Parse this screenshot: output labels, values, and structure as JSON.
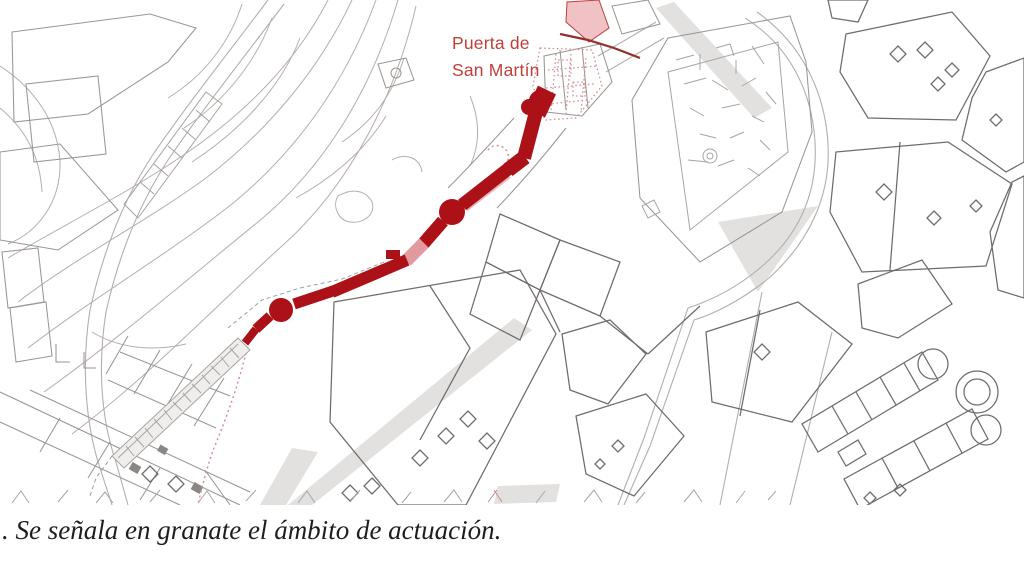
{
  "map": {
    "gate_label": "Puerta de\nSan Martín",
    "caption": ". Se señala en granate el ámbito de actuación."
  },
  "colors": {
    "highlight_red": "#ab1116",
    "highlight_pink": "#e39a9e",
    "label_red": "#bf3f3a",
    "stipple_red": "#d98e91",
    "line_dark": "#6f6b68",
    "fill_gray": "#e3e1df",
    "caption_text": "#1e1e1e"
  }
}
